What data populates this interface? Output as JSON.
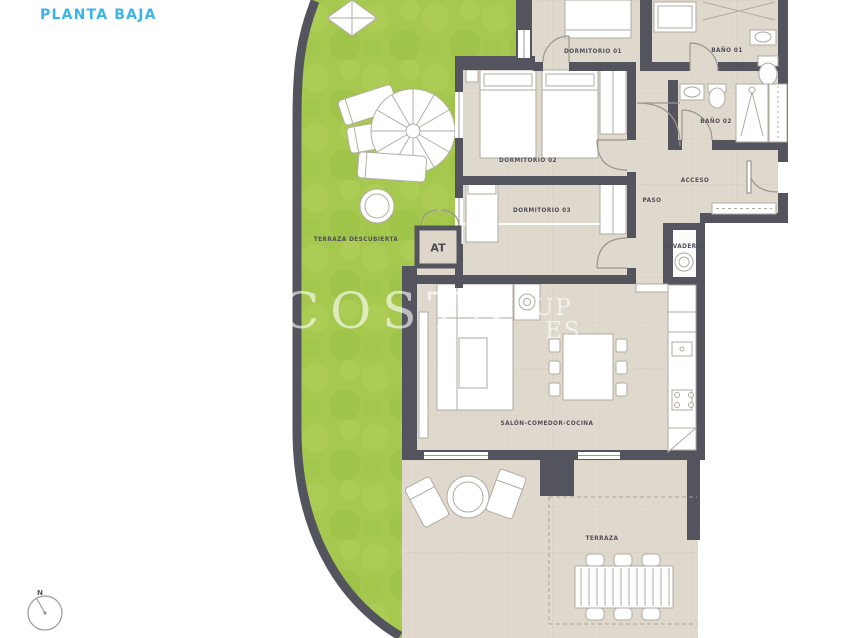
{
  "page": {
    "title": "PLANTA BAJA"
  },
  "colors": {
    "accent": "#3cb4e7",
    "wall": "#54545f",
    "grass": "#a6c84f",
    "floor": "#e2dcd1"
  },
  "rooms": [
    {
      "id": "dormitorio-01",
      "label": "DORMITORIO 01"
    },
    {
      "id": "bano-01",
      "label": "BAÑO 01"
    },
    {
      "id": "bano-02",
      "label": "BAÑO 02"
    },
    {
      "id": "acceso",
      "label": "ACCESO"
    },
    {
      "id": "paso",
      "label": "PASO"
    },
    {
      "id": "lavadero",
      "label": "LAVADERO"
    },
    {
      "id": "dormitorio-02",
      "label": "DORMITORIO 02"
    },
    {
      "id": "dormitorio-03",
      "label": "DORMITORIO 03"
    },
    {
      "id": "terraza-descubierta",
      "label": "TERRAZA DESCUBIERTA"
    },
    {
      "id": "salon-comedor-cocina",
      "label": "SALÓN-COMEDOR-COCINA"
    },
    {
      "id": "terraza",
      "label": "TERRAZA"
    }
  ],
  "annotations": {
    "at_box": "AT",
    "north": "N"
  },
  "watermark": {
    "part1": "COSTA",
    "part2": "UP",
    "part3": "ES"
  }
}
